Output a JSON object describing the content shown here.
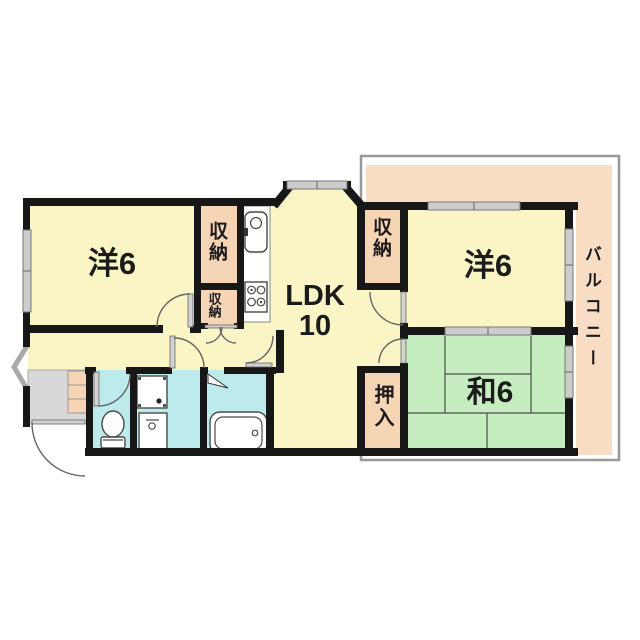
{
  "plan_title": "2LDK apartment floor plan",
  "labels": {
    "western_room_left": "洋6",
    "western_room_right": "洋6",
    "ldk": "LDK",
    "ldk_size": "10",
    "japanese_room": "和6",
    "closet_upper": "収納",
    "closet_hall": "収納",
    "closet_east": "収納",
    "oshiire": "押入",
    "balcony": "バルコニー"
  },
  "colors": {
    "room": "#F9F5C4",
    "closet": "#F6D5B5",
    "balcony": "#F8DCC4",
    "tatami": "#C5EDBF",
    "wet_area": "#BDEAEA",
    "entry": "#D8D8D8",
    "wall": "#171717",
    "window": "#CCCCCC",
    "outline": "#999999"
  },
  "fixtures": [
    "kitchen-sink-icon",
    "stove-icon",
    "toilet-icon",
    "washing-machine-icon",
    "vanity-sink-icon",
    "bathtub-icon",
    "shoe-cabinet-icon"
  ]
}
